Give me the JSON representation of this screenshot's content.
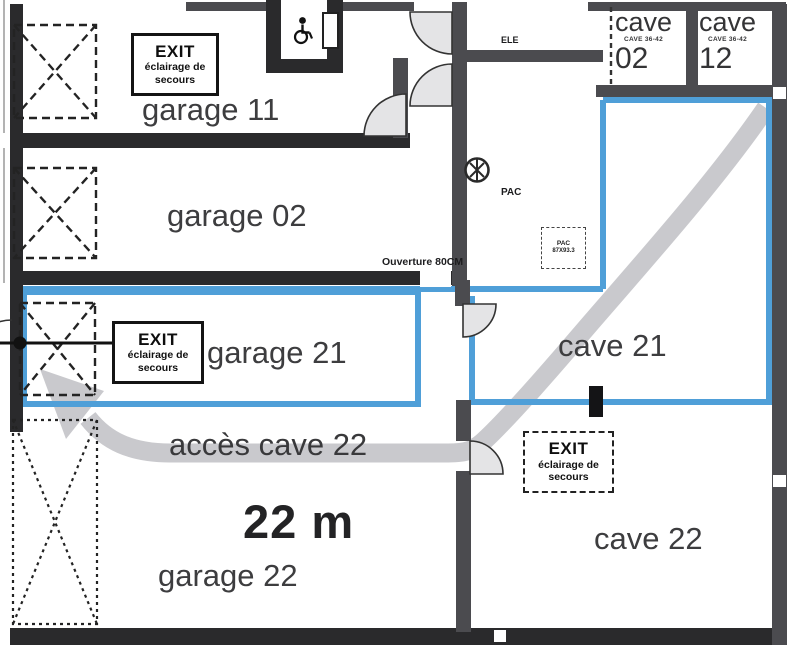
{
  "rooms": {
    "garage11": "garage 11",
    "garage02": "garage 02",
    "garage21": "garage 21",
    "garage22": "garage 22",
    "cave21": "cave 21",
    "cave22": "cave 22",
    "cave02": {
      "word": "cave",
      "small": "CAVE 36-42",
      "num": "02"
    },
    "cave12": {
      "word": "cave",
      "small": "CAVE 36-42",
      "num": "12"
    },
    "pac": "PAC",
    "ele": "ELE"
  },
  "exit_sign": {
    "title": "EXIT",
    "line2": "éclairage de",
    "line3": "secours"
  },
  "annotations": {
    "acces": "accès cave 22",
    "distance": "22 m",
    "ouverture": "Ouverture 80CM",
    "pac_box_title": "PAC",
    "pac_box_dim": "87X93.3"
  },
  "colors": {
    "route_blue": "#4f9fd8",
    "arrow_gray": "#c9c9cd",
    "wall_dark": "#2a2a2c",
    "wall_gray": "#4b4b4f",
    "fan_fill": "#e4e4e6"
  }
}
